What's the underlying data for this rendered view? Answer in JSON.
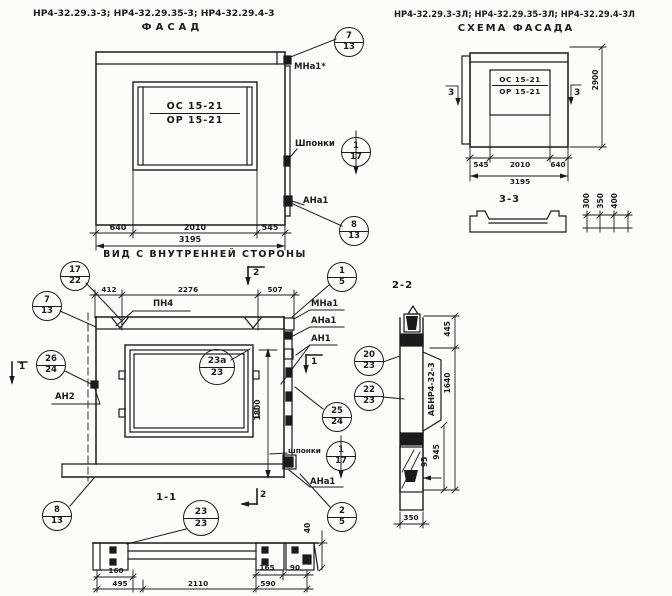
{
  "titles": {
    "series_left": "НР4-32.29.3-3; НР4-32.29.35-3; НР4-32.29.4-3",
    "facade": "ФАСАД",
    "series_right": "НР4-32.29.3-3Л; НР4-32.29.35-3Л; НР4-32.29.4-3Л",
    "scheme": "СХЕМА ФАСАДА",
    "inner_view": "ВИД С ВНУТРЕННЕЙ СТОРОНЫ",
    "section11": "1-1",
    "section22": "2-2",
    "section33": "3-3"
  },
  "facade": {
    "marks": {
      "top": "ОС 15-21",
      "bottom": "ОР 15-21"
    },
    "dims": {
      "d640": "640",
      "d2010": "2010",
      "d545": "545",
      "d3195": "3195"
    },
    "labels": {
      "mna1": "МНа1*",
      "shponki": "Шпонки",
      "ana1": "АНа1"
    }
  },
  "scheme": {
    "marks": {
      "top": "ОС 15-21",
      "bottom": "ОР 15-21"
    },
    "dims": {
      "d545": "545",
      "d2010": "2010",
      "d640": "640",
      "d3195": "3195",
      "d2900": "2900"
    }
  },
  "inner": {
    "dims": {
      "d412": "412",
      "d2276": "2276",
      "d507": "507",
      "d1800": "1800"
    },
    "labels": {
      "pn4": "ПН4",
      "mna1": "МНа1",
      "ana1_top": "АНа1",
      "an1": "АН1",
      "an2": "АН2",
      "shponki": "шпонки",
      "ana1_bottom": "АНа1"
    }
  },
  "section11": {
    "dims": {
      "d40": "40",
      "d160": "160",
      "d495": "495",
      "d2110": "2110",
      "d165": "165",
      "d590": "590",
      "d90": "90"
    }
  },
  "section22": {
    "panel_mark": "АБНР4-32-3",
    "dims": {
      "d445": "445",
      "d1640": "1640",
      "d945": "945",
      "d95": "95",
      "d350": "350"
    }
  },
  "section33": {
    "dims": {
      "d300": "300",
      "d350": "350",
      "d400": "400"
    }
  },
  "markers": {
    "m1": "1",
    "m2": "2",
    "m3": "3"
  },
  "callouts": {
    "f7": {
      "top": "7",
      "bottom": "13"
    },
    "f117": {
      "top": "1",
      "bottom": "17"
    },
    "f8": {
      "top": "8",
      "bottom": "13"
    },
    "i1722": {
      "top": "17",
      "bottom": "22"
    },
    "i713": {
      "top": "7",
      "bottom": "13"
    },
    "i15": {
      "top": "1",
      "bottom": "5"
    },
    "i2624": {
      "top": "26",
      "bottom": "24"
    },
    "i23a": {
      "top": "23а",
      "bottom": "23"
    },
    "i2524": {
      "top": "25",
      "bottom": "24"
    },
    "i117": {
      "top": "1",
      "bottom": "17"
    },
    "i25": {
      "top": "2",
      "bottom": "5"
    },
    "s2023": {
      "top": "20",
      "bottom": "23"
    },
    "s2223": {
      "top": "22",
      "bottom": "23"
    },
    "b813": {
      "top": "8",
      "bottom": "13"
    },
    "b2323": {
      "top": "23",
      "bottom": "23"
    }
  }
}
